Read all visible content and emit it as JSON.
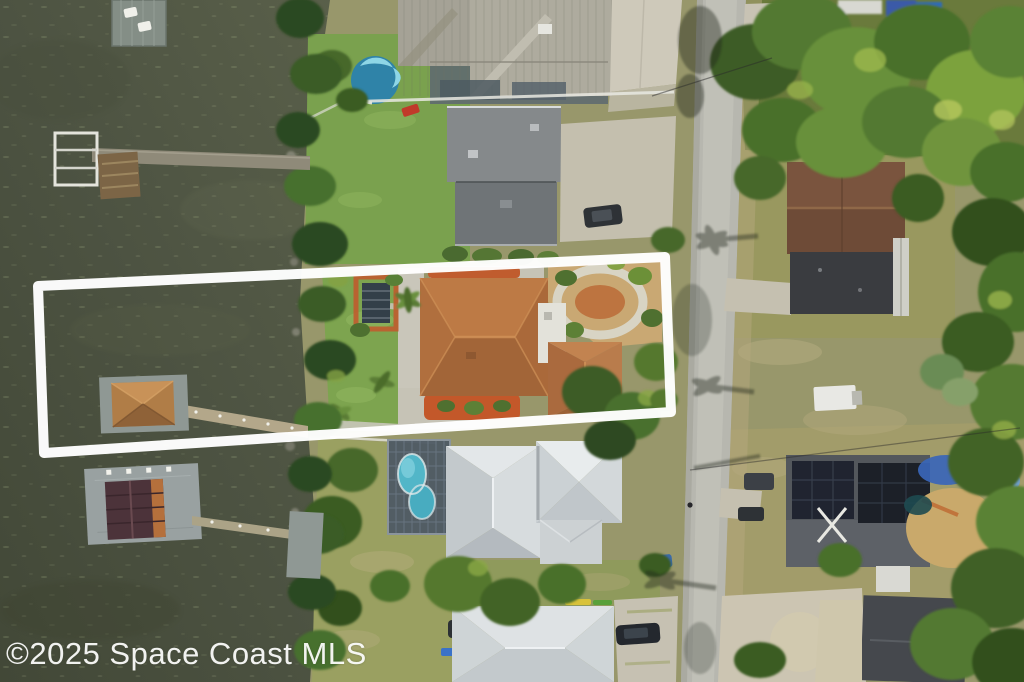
{
  "watermark": {
    "text": "©2025 Space Coast MLS"
  },
  "scene": {
    "type": "aerial-photograph",
    "subject": "waterfront residential parcel highlighted with a white boundary outline, river on the left, street on the right",
    "property_outline_color": "#ffffff",
    "colors": {
      "water": "#4d5342",
      "water_dark": "#424837",
      "shore_vegetation": "#35521f",
      "lawn_green": "#7ca24e",
      "dry_lawn": "#9c9a63",
      "road": "#b8b8b0",
      "concrete": "#c9c5b6",
      "subject_roof_brown": "#b06f3e",
      "mulch_orange": "#c05c2e",
      "metal_roof_tan": "#a9a79b",
      "white_metal_roof": "#d3d7d9",
      "gray_flat_roof": "#85898b",
      "dark_roof": "#3e4146",
      "solar_panels": "#1e222a",
      "pool_blue": "#52b6c8",
      "boathouse_roof": "#4c333a",
      "dock_gray": "#99a1a1"
    },
    "features": [
      "river-water",
      "north-dock-with-boat-lift",
      "sun-deck-platform",
      "subject-dock-tan-roof",
      "south-boathouse-dark-roof",
      "property-outline",
      "subject-house-brown-shingle-roof",
      "garden-loop-path",
      "pergola",
      "north-neighbor-gray-roof-house",
      "north-metal-roof-house",
      "round-above-ground-pool",
      "screened-pool-enclosure",
      "south-white-metal-roof-house",
      "bottom-white-roof-house",
      "street",
      "east-house-brown-gable",
      "east-house-solar-panels",
      "bottom-right-dark-roof-house",
      "utility-trailer",
      "parked-cars",
      "tree-canopies",
      "palm-shadows-on-road",
      "mls-watermark"
    ]
  }
}
